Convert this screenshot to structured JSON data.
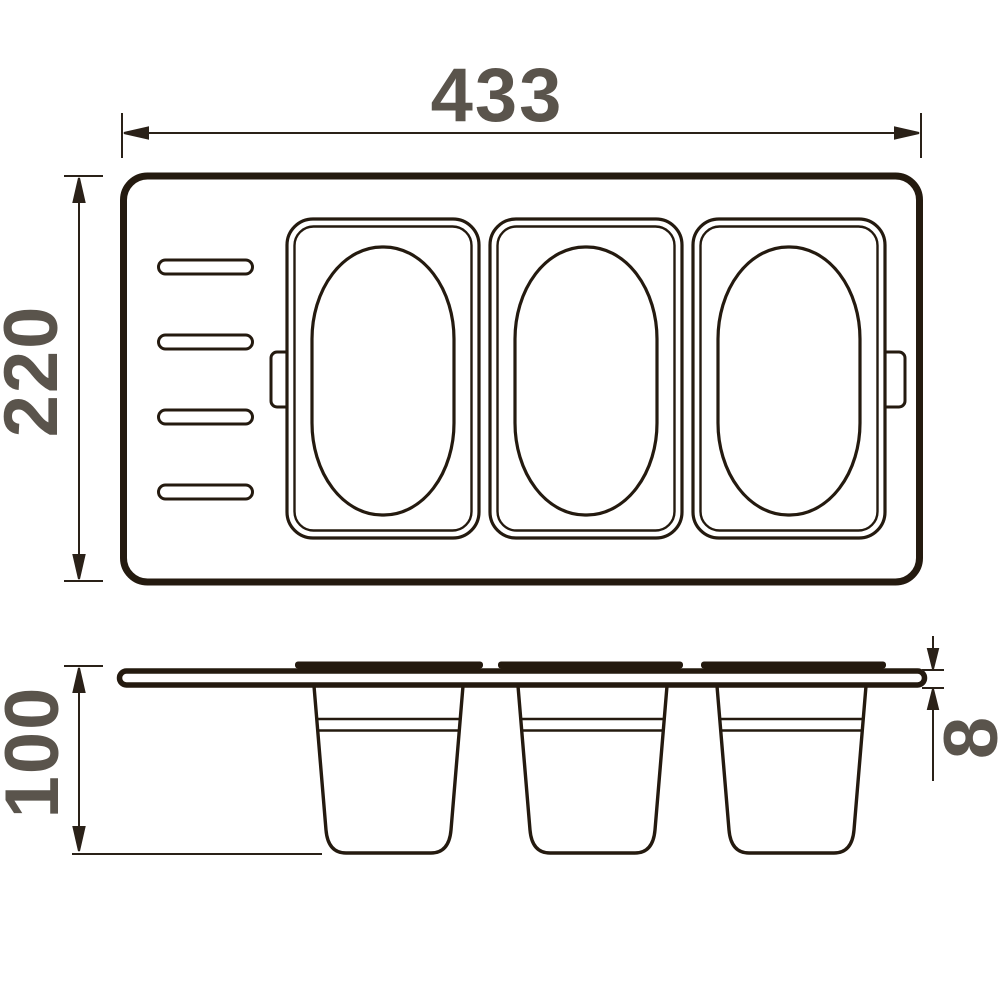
{
  "drawing": {
    "type": "technical-dimension-drawing",
    "subject": "three-bin organizer tray, top view and side view",
    "dimensions": {
      "overall_width": "433",
      "overall_depth": "220",
      "bin_height": "100",
      "plate_thickness": "8"
    },
    "counts": {
      "bins": 3,
      "left_slots": 4
    },
    "colors": {
      "ink": "#241a0f",
      "dim_line": "#2a2118",
      "label_text": "#5a544c",
      "background": "#ffffff"
    }
  }
}
